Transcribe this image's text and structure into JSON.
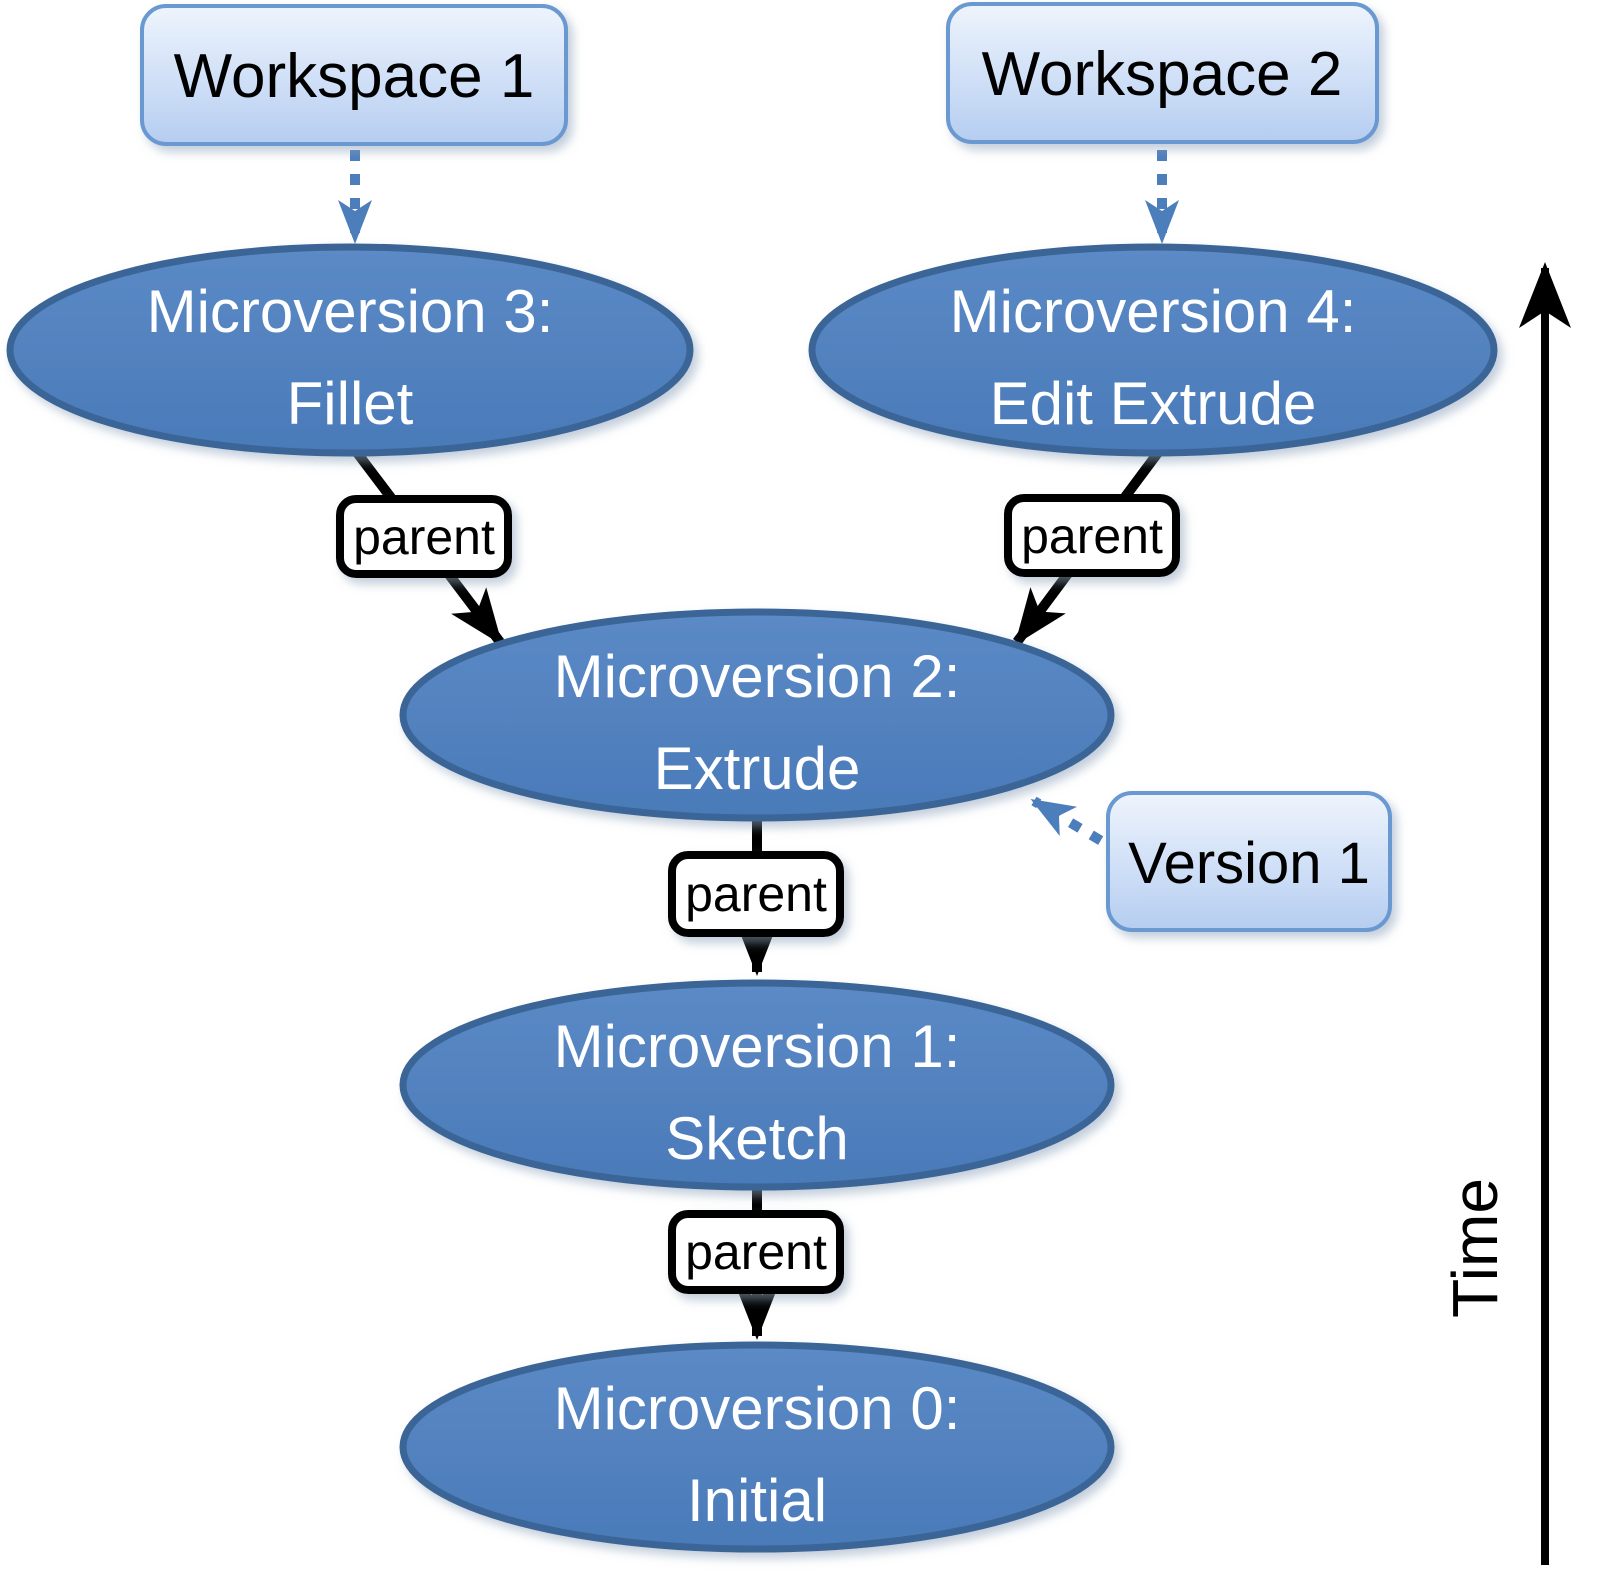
{
  "diagram": {
    "workspace_boxes": [
      {
        "label": "Workspace 1"
      },
      {
        "label": "Workspace 2"
      }
    ],
    "version_box": {
      "label": "Version 1"
    },
    "nodes": [
      {
        "id": "microversion-3",
        "line1": "Microversion 3:",
        "line2": "Fillet"
      },
      {
        "id": "microversion-4",
        "line1": "Microversion 4:",
        "line2": "Edit Extrude"
      },
      {
        "id": "microversion-2",
        "line1": "Microversion 2:",
        "line2": "Extrude"
      },
      {
        "id": "microversion-1",
        "line1": "Microversion 1:",
        "line2": "Sketch"
      },
      {
        "id": "microversion-0",
        "line1": "Microversion 0:",
        "line2": "Initial"
      }
    ],
    "edge_label": "parent",
    "time_axis": {
      "label": "Time"
    },
    "colors": {
      "node_fill": "#4d7ebc",
      "node_border": "#3a6596",
      "node_text": "#ffffff",
      "callout_fill_top": "#eef4fc",
      "callout_fill_bottom": "#b5cdf0",
      "callout_border": "#6b98d0",
      "callout_text": "#000000",
      "edge_black": "#000000",
      "edge_blue": "#4d7ebc",
      "parent_box_fill": "#ffffff",
      "parent_box_border": "#000000"
    }
  }
}
